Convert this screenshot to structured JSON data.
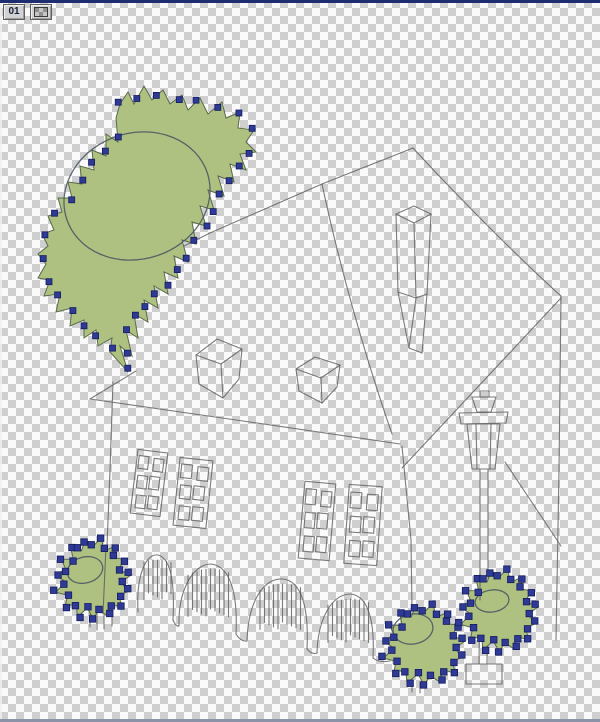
{
  "frame_indicator": {
    "frame_number": "01",
    "icon": "transparency-icon"
  },
  "canvas": {
    "checker_light": "#fafafa",
    "checker_dark": "#cfcfcf",
    "checker_size_px": 8,
    "top_border_color": "#1e2c72",
    "bottom_border_color": "#8b93a9"
  },
  "artwork": {
    "colors": {
      "sketch": "#5d5d5d",
      "fill_green": "#aec180",
      "blob_outline": "#5a6a4a",
      "node_fill": "#2e3a95",
      "node_edge": "#141d5e",
      "inner_ellipse": "#4e5a64"
    },
    "sketch_paths": [
      "M413,148 L322,184",
      "M322,184 L210,233 L98,289",
      "M322,184 C333,236 356,330 392,434",
      "M413,148 C446,184 512,252 561,296",
      "M561,296 L559,470 L556,640",
      "M561,298 L402,468",
      "M90,399 L243,421 L400,444",
      "M90,399 L136,371",
      "M113,382 L110,470 L107,546",
      "M402,446 L411,540 L412,610",
      "M505,462 L561,546",
      "M396,214 L414,206 L431,214 L414,223 Z",
      "M396,214 L398,292 L409,348",
      "M431,214 L427,294 L422,353",
      "M414,223 L416,298 L409,348 L422,353",
      "M398,292 L416,298 L427,294",
      "M196,355 L217,339 L242,349 L221,364 Z",
      "M196,355 L199,384 L223,398 L221,364",
      "M242,349 L239,379 L223,398",
      "M296,369 L315,357 L340,365 L321,378 Z",
      "M296,369 L299,391 L322,403 L321,378",
      "M340,365 L337,387 L322,403",
      "M480,391 L489,391 L489,397 L480,397 Z",
      "M472,397 L496,397 L491,412 L477,412 Z",
      "M459,413 L508,412 L506,423 L461,424 Z",
      "M467,424 L500,424 L495,469 L472,469 Z",
      "M476,424 L477,469",
      "M491,424 L490,469",
      "M480,470 L480,566 L479,664",
      "M488,470 L488,566 L487,664",
      "M466,664 L502,664 L502,684 L466,684 Z",
      "M138,612 C136,575 146,553 158,555 C170,558 175,580 173,620",
      "M179,626 C178,592 192,564 211,564 C229,566 238,590 236,634",
      "M247,641 C248,604 262,578 283,579 C301,581 309,606 307,649",
      "M317,653 C318,618 332,594 351,594 C367,596 375,618 373,658",
      "M173,620 Q176,627 179,626",
      "M236,634 Q241,642 247,641",
      "M307,649 Q312,655 317,653",
      "M373,658 Q379,663 390,661",
      "M90,612 L90,627",
      "M97,614 L97,630",
      "M104,615 L104,629",
      "M112,614 L112,626",
      "M412,680 L412,692",
      "M420,682 L420,693"
    ],
    "hedge_hatches": [
      {
        "px": 156,
        "py": 557,
        "x0": 144,
        "x1": 172,
        "depth": 40
      },
      {
        "px": 211,
        "py": 566,
        "x0": 188,
        "x1": 232,
        "depth": 48
      },
      {
        "px": 283,
        "py": 581,
        "x0": 260,
        "x1": 304,
        "depth": 46
      },
      {
        "px": 351,
        "py": 596,
        "x0": 328,
        "x1": 370,
        "depth": 44
      }
    ],
    "windows": [
      {
        "cx": 149,
        "cy": 483,
        "w": 30,
        "h": 64,
        "rot": 7
      },
      {
        "cx": 193,
        "cy": 493,
        "w": 33,
        "h": 68,
        "rot": 6
      },
      {
        "cx": 317,
        "cy": 521,
        "w": 31,
        "h": 77,
        "rot": 5
      },
      {
        "cx": 363,
        "cy": 525,
        "w": 33,
        "h": 79,
        "rot": 4
      }
    ],
    "tree": {
      "points": [
        [
          120,
          104
        ],
        [
          128,
          92
        ],
        [
          134,
          104
        ],
        [
          144,
          86
        ],
        [
          152,
          100
        ],
        [
          163,
          90
        ],
        [
          170,
          104
        ],
        [
          182,
          95
        ],
        [
          188,
          110
        ],
        [
          200,
          98
        ],
        [
          208,
          114
        ],
        [
          222,
          102
        ],
        [
          226,
          118
        ],
        [
          240,
          112
        ],
        [
          238,
          128
        ],
        [
          254,
          130
        ],
        [
          246,
          142
        ],
        [
          256,
          152
        ],
        [
          240,
          154
        ],
        [
          246,
          170
        ],
        [
          230,
          164
        ],
        [
          234,
          182
        ],
        [
          218,
          176
        ],
        [
          224,
          196
        ],
        [
          208,
          190
        ],
        [
          214,
          210
        ],
        [
          200,
          206
        ],
        [
          206,
          226
        ],
        [
          192,
          222
        ],
        [
          196,
          244
        ],
        [
          182,
          240
        ],
        [
          188,
          262
        ],
        [
          174,
          256
        ],
        [
          178,
          278
        ],
        [
          164,
          272
        ],
        [
          168,
          294
        ],
        [
          154,
          286
        ],
        [
          158,
          308
        ],
        [
          144,
          300
        ],
        [
          148,
          322
        ],
        [
          134,
          314
        ],
        [
          138,
          338
        ],
        [
          126,
          330
        ],
        [
          132,
          356
        ],
        [
          120,
          346
        ],
        [
          128,
          372
        ],
        [
          110,
          352
        ],
        [
          112,
          338
        ],
        [
          98,
          346
        ],
        [
          96,
          330
        ],
        [
          84,
          338
        ],
        [
          84,
          320
        ],
        [
          70,
          326
        ],
        [
          72,
          308
        ],
        [
          56,
          312
        ],
        [
          60,
          294
        ],
        [
          44,
          296
        ],
        [
          50,
          280
        ],
        [
          38,
          278
        ],
        [
          46,
          264
        ],
        [
          38,
          254
        ],
        [
          48,
          246
        ],
        [
          42,
          234
        ],
        [
          54,
          230
        ],
        [
          48,
          216
        ],
        [
          62,
          212
        ],
        [
          58,
          198
        ],
        [
          72,
          198
        ],
        [
          68,
          182
        ],
        [
          82,
          184
        ],
        [
          80,
          166
        ],
        [
          94,
          170
        ],
        [
          92,
          150
        ],
        [
          106,
          156
        ],
        [
          106,
          134
        ],
        [
          118,
          142
        ],
        [
          116,
          118
        ]
      ],
      "ellipse": {
        "cx": 137,
        "cy": 196,
        "rx": 74,
        "ry": 63,
        "rot": -18
      },
      "node_count": 38,
      "node_size": 6
    },
    "bushes": [
      {
        "cx": 93,
        "cy": 579,
        "rx": 33,
        "ry": 36,
        "n": 30,
        "amp": 5,
        "ellipse": {
          "cx": 85,
          "cy": 570,
          "rx": 18,
          "ry": 13,
          "rot": -15
        },
        "node_count": 30,
        "node_size": 6.5
      },
      {
        "cx": 424,
        "cy": 645,
        "rx": 36,
        "ry": 36,
        "n": 30,
        "amp": 5,
        "ellipse": {
          "cx": 413,
          "cy": 629,
          "rx": 20,
          "ry": 15,
          "rot": -10
        },
        "node_count": 30,
        "node_size": 6.5
      },
      {
        "cx": 499,
        "cy": 611,
        "rx": 34,
        "ry": 37,
        "n": 30,
        "amp": 5,
        "ellipse": {
          "cx": 492,
          "cy": 601,
          "rx": 17,
          "ry": 11,
          "rot": -8
        },
        "node_count": 30,
        "node_size": 6.5
      }
    ],
    "overlay_paths": [
      "M106,546 L103,614",
      "M480,574 L480,600"
    ]
  }
}
